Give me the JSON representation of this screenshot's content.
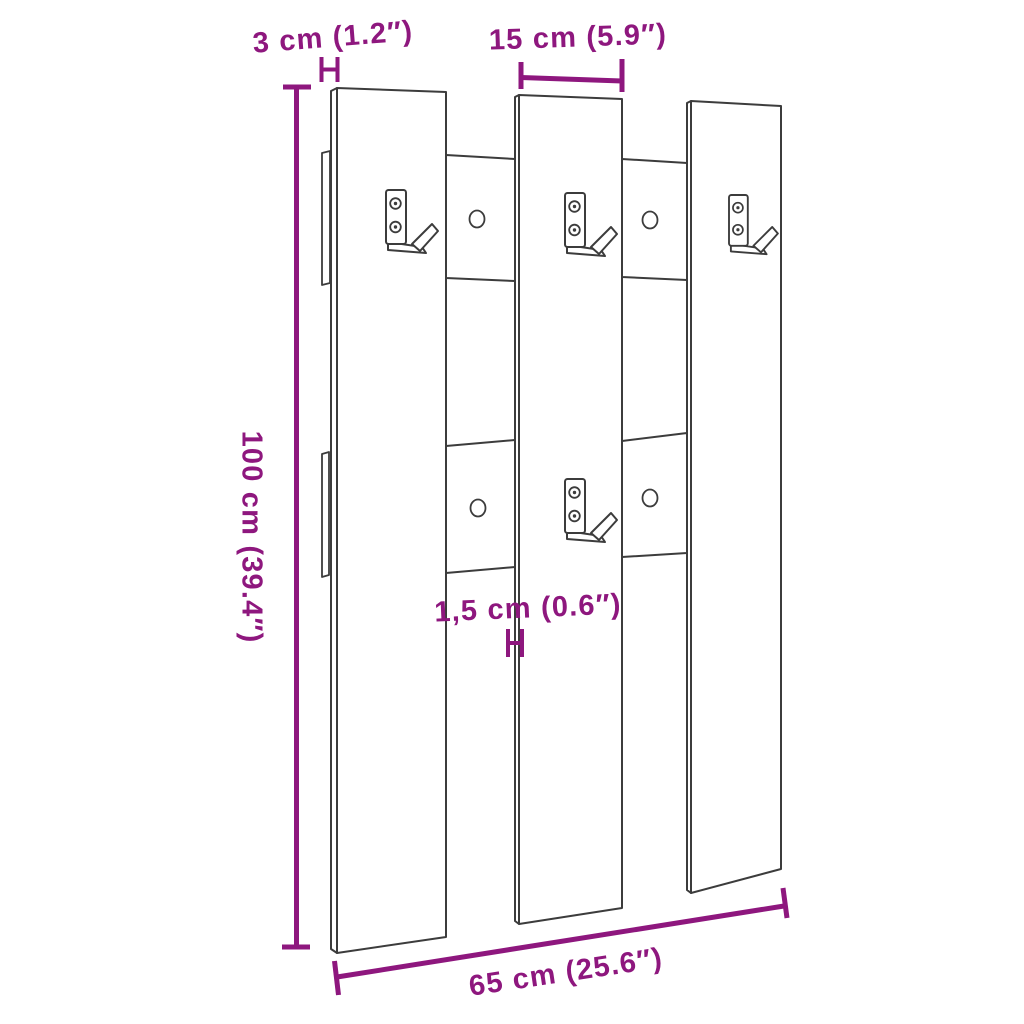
{
  "diagram": {
    "product": "Wall-mounted coat rack with three vertical slats, two rear battens and metal hooks",
    "colors": {
      "dimension_accent": "#8E177E",
      "line_art": "#3C3C3C",
      "background": "#FFFFFF"
    },
    "dimensions": {
      "depth": {
        "label": "3 cm (1.2″)",
        "cm": "3",
        "inches": "1.2"
      },
      "hook_panel_width": {
        "label": "15 cm (5.9″)",
        "cm": "15",
        "inches": "5.9"
      },
      "height": {
        "label": "100 cm (39.4″)",
        "cm": "100",
        "inches": "39.4"
      },
      "board_thickness": {
        "label": "1,5 cm (0.6″)",
        "cm": "1,5",
        "inches": "0.6"
      },
      "width": {
        "label": "65 cm (25.6″)",
        "cm": "65",
        "inches": "25.6"
      }
    },
    "counts": {
      "slats": 3,
      "batten_rows": 2,
      "hooks": 4,
      "batten_screw_holes": 4,
      "screws_per_hook": 2
    }
  }
}
